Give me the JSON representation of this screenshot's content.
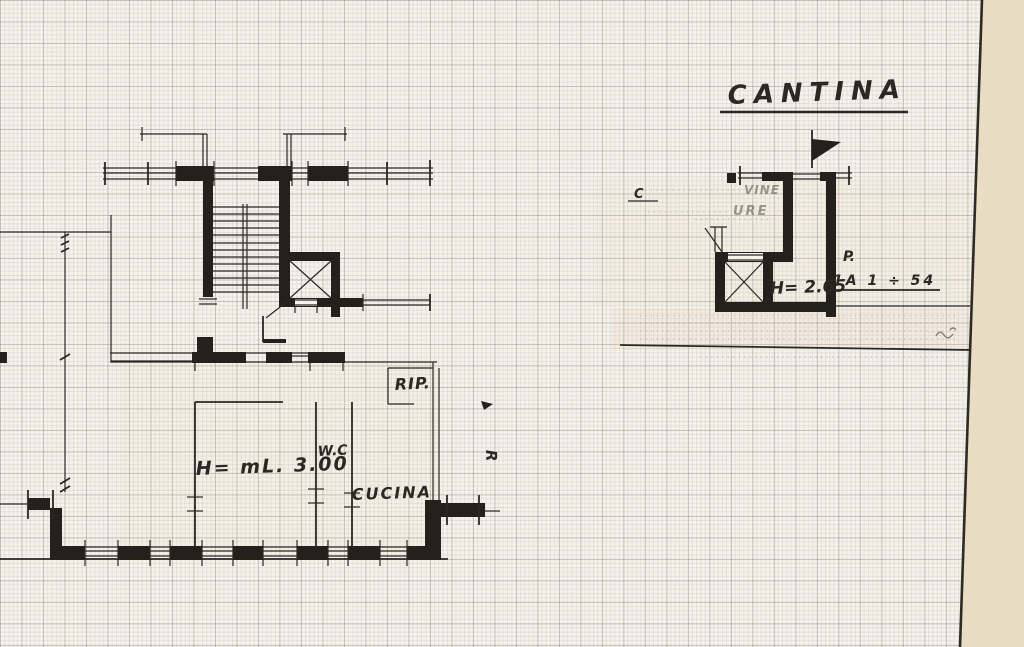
{
  "page": {
    "background": "#f5f2eb",
    "margin_color": "#e8ddc3",
    "ink_color": "#2a2724"
  },
  "cantina": {
    "title": "CANTINA",
    "height_label": "H= 2.65",
    "ref_label": "P.",
    "ref_value": "1A 1 ÷ 54",
    "c_mark": "C",
    "faint_note_top": "VINE",
    "faint_note_bottom": "URE"
  },
  "apartment": {
    "closet_label": "RIP.",
    "wc_label": "W.C",
    "height_label": "H= mL. 3.00",
    "kitchen_label": "CUCINA",
    "r_mark": "R"
  }
}
